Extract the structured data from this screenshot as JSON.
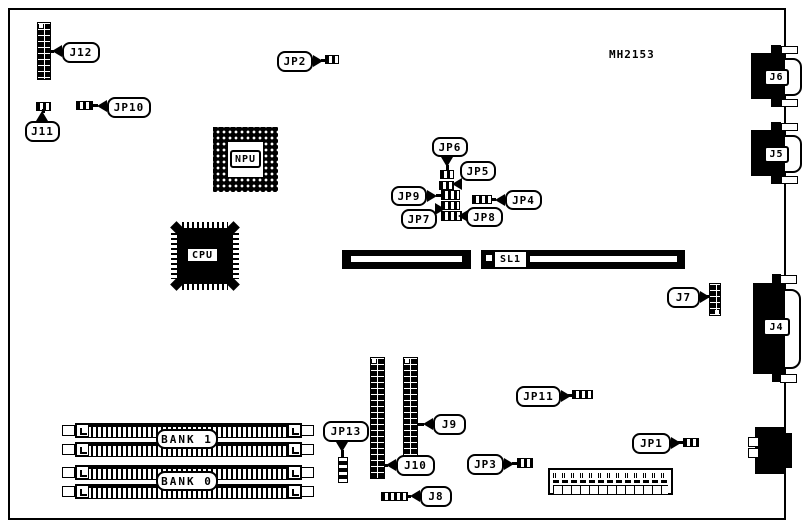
{
  "annotations": {
    "part_number": "MH2153"
  },
  "callouts": {
    "j12": "J12",
    "j11": "J11",
    "jp10": "JP10",
    "jp2": "JP2",
    "jp6": "JP6",
    "jp5": "JP5",
    "jp9": "JP9",
    "jp4": "JP4",
    "jp7": "JP7",
    "jp8": "JP8",
    "j7": "J7",
    "jp11": "JP11",
    "j9": "J9",
    "j10": "J10",
    "jp13": "JP13",
    "j8": "J8",
    "jp3": "JP3",
    "jp1": "JP1"
  },
  "chips": {
    "npu_label": "NPU",
    "cpu_label": "CPU"
  },
  "slots": {
    "sl1_label": "SL1"
  },
  "memory_banks": {
    "bank1_label": "BANK 1",
    "bank0_label": "BANK 0"
  },
  "edge_connectors": {
    "j6_label": "J6",
    "j5_label": "J5",
    "j4_label": "J4"
  },
  "colors": {
    "ink": "#000000",
    "paper": "#ffffff"
  }
}
